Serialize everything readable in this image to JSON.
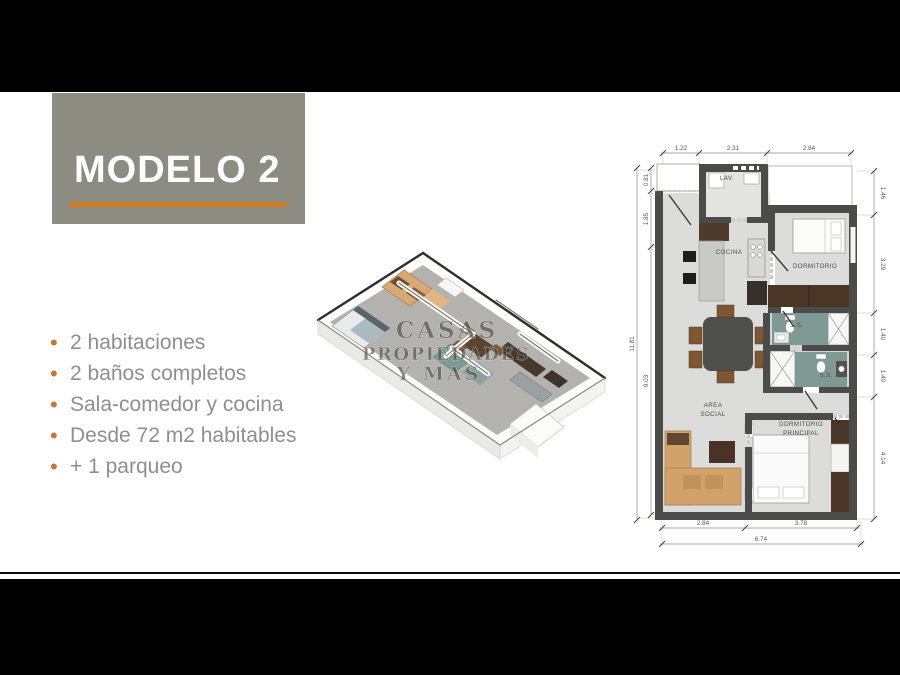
{
  "title_card": {
    "label": "MODELO 2"
  },
  "features": {
    "items": [
      "2 habitaciones",
      "2 baños completos",
      "Sala-comedor y cocina",
      "Desde 72 m2 habitables",
      "+ 1 parqueo"
    ]
  },
  "watermark": {
    "line1": "CASAS",
    "line2": "PROPIEDADES",
    "line3": "Y MAS"
  },
  "plan": {
    "rooms": {
      "lav": "LAV.",
      "cocina": "COCINA",
      "dormitorio": "DORMITORIO",
      "bath1": "S.S.",
      "bath2": "S.S.",
      "area_line1": "AREA",
      "area_line2": "SOCIAL",
      "principal_line1": "DORMITORIO",
      "principal_line2": "PRINCIPAL"
    },
    "dims": {
      "top1": "1.22",
      "top2": "2.31",
      "top3": "2.84",
      "left_total": "11.81",
      "left1": "0.81",
      "left2": "1.85",
      "left3": "9.03",
      "right1": "1.46",
      "right2": "3.29",
      "right3": "1.40",
      "right4": "1.40",
      "right5": "4.14",
      "bottom1": "2.84",
      "bottom2": "3.78",
      "bottom_total": "6.74"
    }
  },
  "colors": {
    "accent_orange": "#d07c20",
    "card_gray": "#8c8c83",
    "feature_text": "#8f8f8f",
    "wall": "#4b4b49",
    "floor": "#dcdcdb",
    "bath_floor": "#7f9a95",
    "wood_dark": "#4a3527",
    "sofa_tan": "#d2a26b"
  }
}
